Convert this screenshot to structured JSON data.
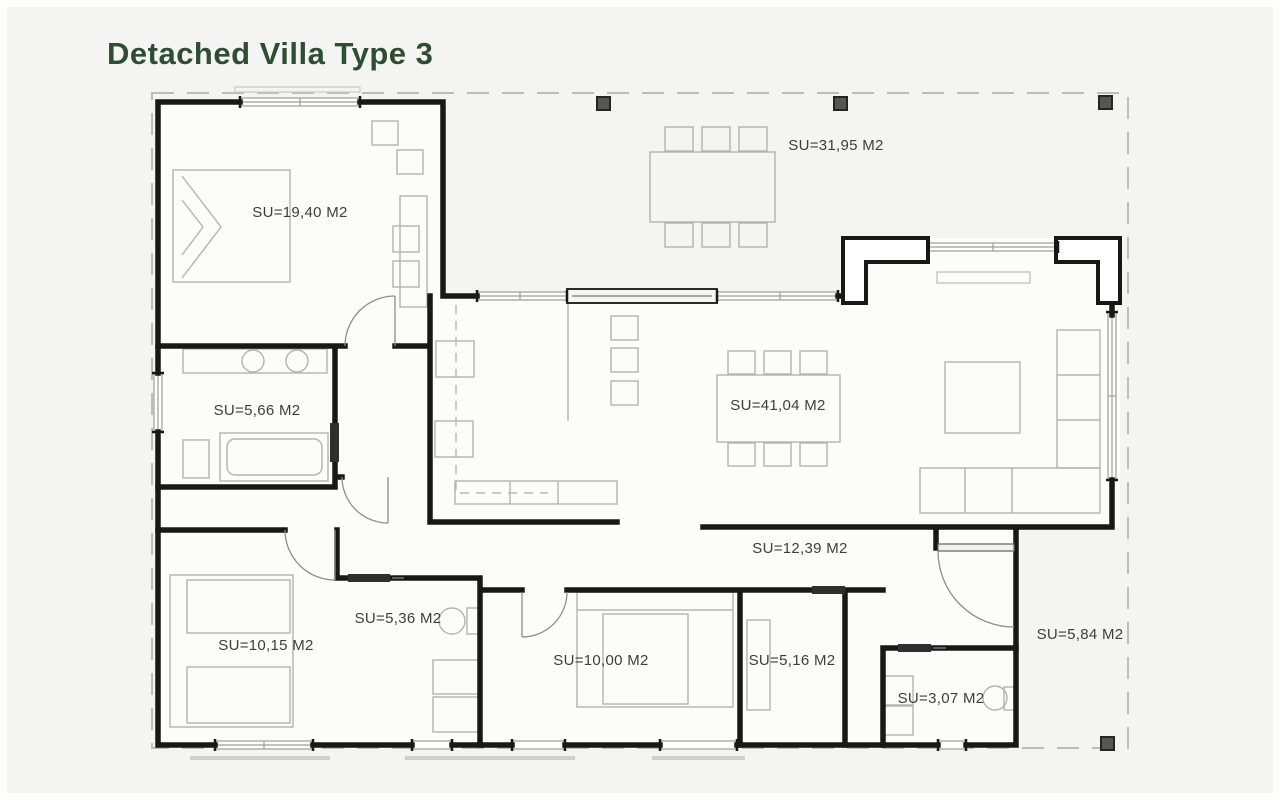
{
  "title": "Detached Villa Type 3",
  "colors": {
    "title": "#2e4d33",
    "wall": "#181818",
    "label": "#3e3e3e",
    "furniture": "#b3b3af",
    "column": "#565654",
    "dashed_outline": "#bcbcb8"
  },
  "plan": {
    "rooms": [
      {
        "name": "bedroom-1",
        "label": "SU=19,40 M2"
      },
      {
        "name": "terrace",
        "label": "SU=31,95 M2"
      },
      {
        "name": "bathroom-1",
        "label": "SU=5,66 M2"
      },
      {
        "name": "living-dining",
        "label": "SU=41,04 M2"
      },
      {
        "name": "hallway",
        "label": "SU=12,39 M2"
      },
      {
        "name": "bedroom-2",
        "label": "SU=10,15 M2"
      },
      {
        "name": "bathroom-2",
        "label": "SU=5,36 M2"
      },
      {
        "name": "bedroom-3",
        "label": "SU=10,00 M2"
      },
      {
        "name": "dressing-room",
        "label": "SU=5,16 M2"
      },
      {
        "name": "wc",
        "label": "SU=3,07 M2"
      },
      {
        "name": "entrance-porch",
        "label": "SU=5,84 M2"
      }
    ]
  }
}
